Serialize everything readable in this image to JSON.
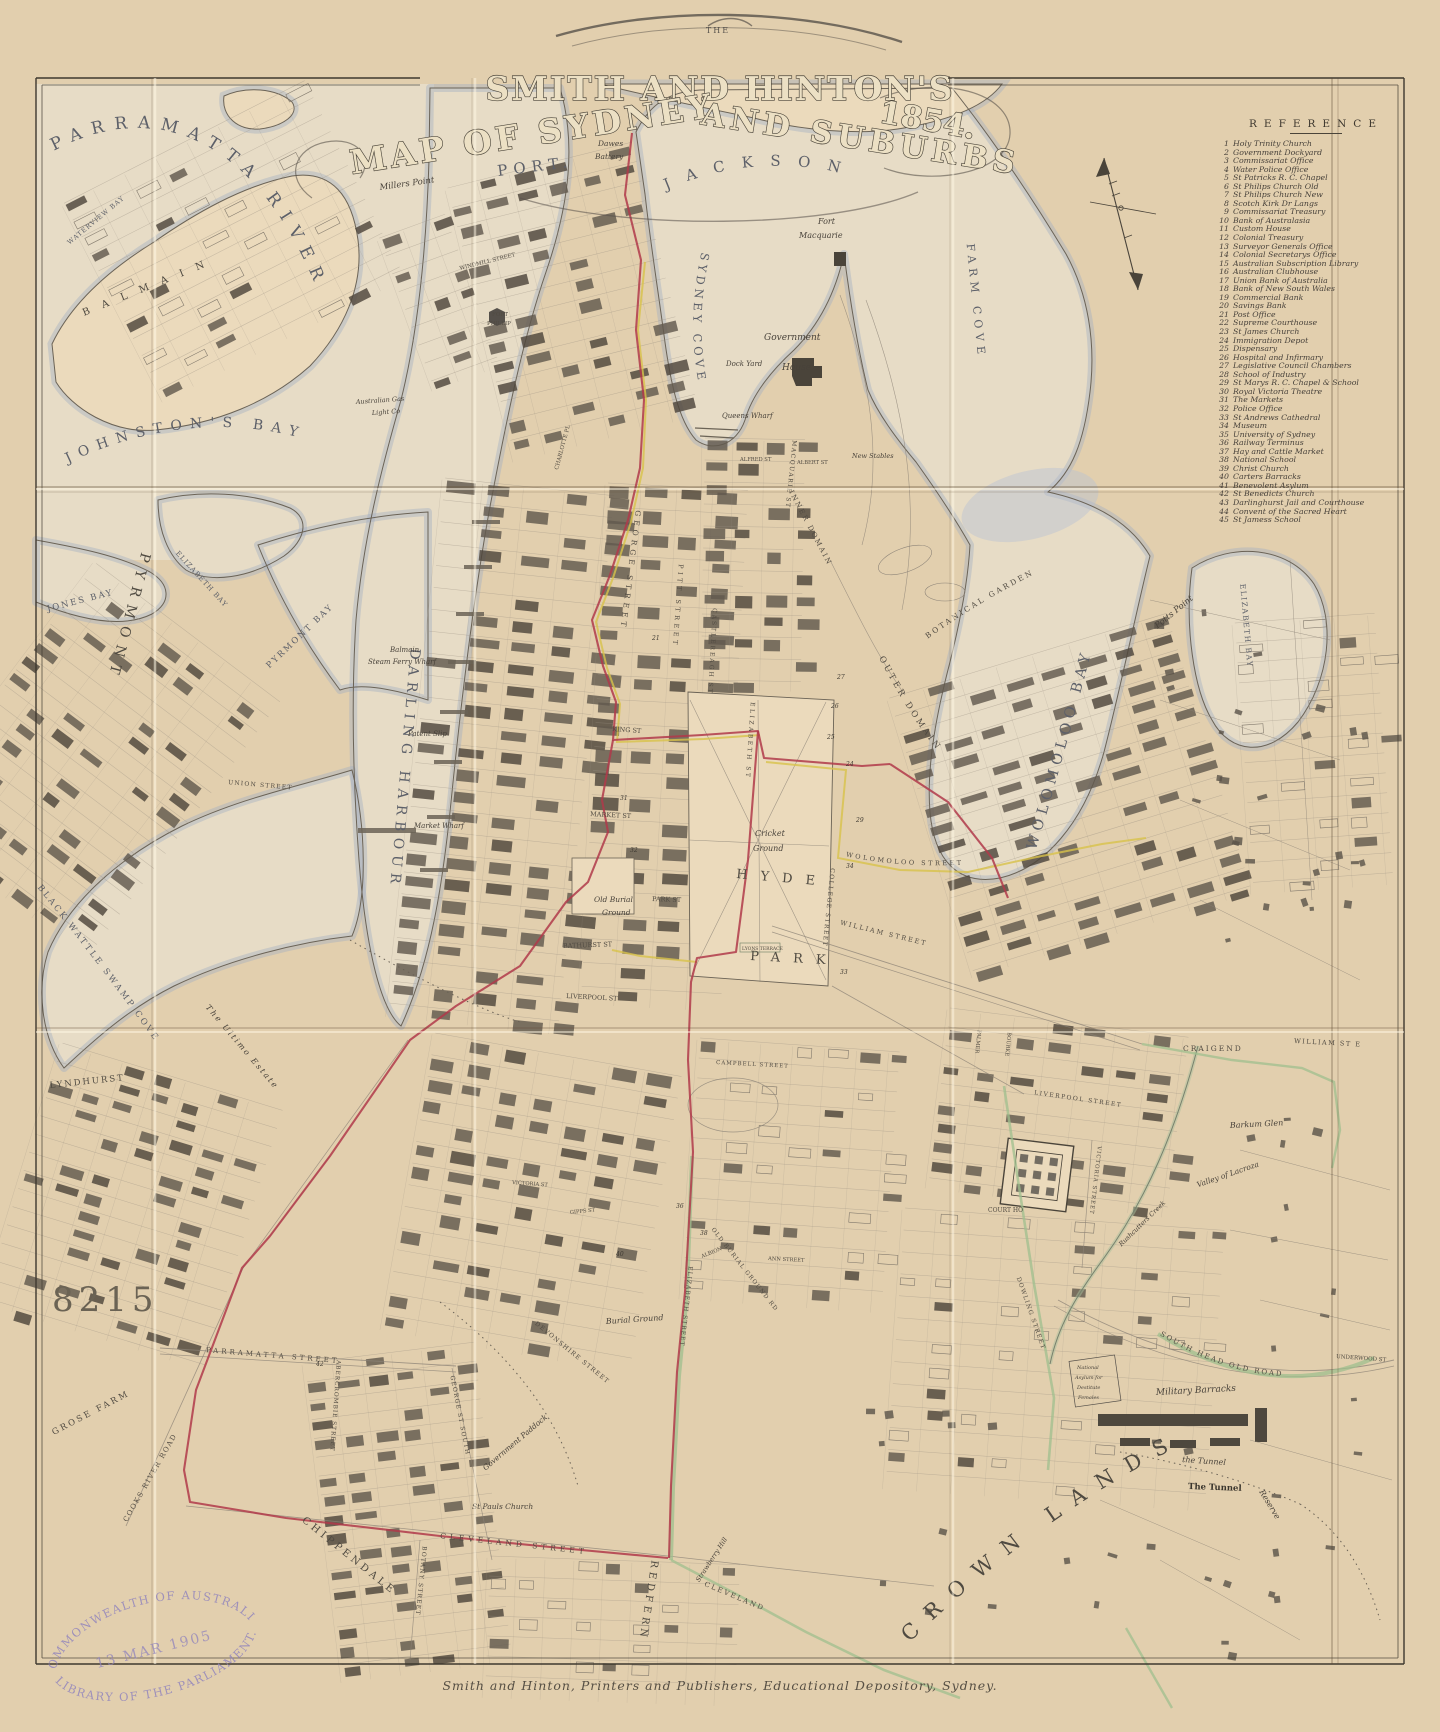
{
  "page": {
    "pretitle": "THE",
    "title_main": "SMITH AND HINTON'S",
    "title_sub_left": "MAP OF SYDNEY",
    "title_sub_right": "AND SUBURBS",
    "title_year": "1854.",
    "imprint": "Smith and Hinton, Printers and Publishers, Educational Depository, Sydney.",
    "accession_number": "8215"
  },
  "stamp": {
    "top": "COMMONWEALTH OF AUSTRALIA",
    "date": "13 MAR 1905",
    "bottom": "LIBRARY OF THE PARLIAMENT."
  },
  "reference": {
    "heading": "REFERENCE",
    "items": [
      {
        "n": "1",
        "label": "Holy Trinity Church"
      },
      {
        "n": "2",
        "label": "Government Dockyard"
      },
      {
        "n": "3",
        "label": "Commissariat Office"
      },
      {
        "n": "4",
        "label": "Water Police Office"
      },
      {
        "n": "5",
        "label": "St Patricks R. C. Chapel"
      },
      {
        "n": "6",
        "label": "St Philips Church Old"
      },
      {
        "n": "7",
        "label": "St Philips Church New"
      },
      {
        "n": "8",
        "label": "Scotch Kirk Dr Langs"
      },
      {
        "n": "9",
        "label": "Commissariat Treasury"
      },
      {
        "n": "10",
        "label": "Bank of Australasia"
      },
      {
        "n": "11",
        "label": "Custom House"
      },
      {
        "n": "12",
        "label": "Colonial Treasury"
      },
      {
        "n": "13",
        "label": "Surveyor Generals Office"
      },
      {
        "n": "14",
        "label": "Colonial Secretarys Office"
      },
      {
        "n": "15",
        "label": "Australian Subscription Library"
      },
      {
        "n": "16",
        "label": "Australian Clubhouse"
      },
      {
        "n": "17",
        "label": "Union Bank of Australia"
      },
      {
        "n": "18",
        "label": "Bank of New South Wales"
      },
      {
        "n": "19",
        "label": "Commercial Bank"
      },
      {
        "n": "20",
        "label": "Savings Bank"
      },
      {
        "n": "21",
        "label": "Post Office"
      },
      {
        "n": "22",
        "label": "Supreme Courthouse"
      },
      {
        "n": "23",
        "label": "St James Church"
      },
      {
        "n": "24",
        "label": "Immigration Depot"
      },
      {
        "n": "25",
        "label": "Dispensary"
      },
      {
        "n": "26",
        "label": "Hospital and Infirmary"
      },
      {
        "n": "27",
        "label": "Legislative Council Chambers"
      },
      {
        "n": "28",
        "label": "School of Industry"
      },
      {
        "n": "29",
        "label": "St Marys R. C. Chapel & School"
      },
      {
        "n": "30",
        "label": "Royal Victoria Theatre"
      },
      {
        "n": "31",
        "label": "The Markets"
      },
      {
        "n": "32",
        "label": "Police Office"
      },
      {
        "n": "33",
        "label": "St Andrews Cathedral"
      },
      {
        "n": "34",
        "label": "Museum"
      },
      {
        "n": "35",
        "label": "University of Sydney"
      },
      {
        "n": "36",
        "label": "Railway Terminus"
      },
      {
        "n": "37",
        "label": "Hay and Cattle Market"
      },
      {
        "n": "38",
        "label": "National School"
      },
      {
        "n": "39",
        "label": "Christ Church"
      },
      {
        "n": "40",
        "label": "Carters Barracks"
      },
      {
        "n": "41",
        "label": "Benevolent Asylum"
      },
      {
        "n": "42",
        "label": "St Benedicts Church"
      },
      {
        "n": "43",
        "label": "Darlinghurst Jail and Courthouse"
      },
      {
        "n": "44",
        "label": "Convent of the Sacred Heart"
      },
      {
        "n": "45",
        "label": "St Jamess School"
      }
    ]
  },
  "map_labels": [
    {
      "t": "PARRAMATTA RIVER",
      "cls": "w",
      "s": 17,
      "ls": 10,
      "p": "M52,152 C150,98 262,128 328,318"
    },
    {
      "t": "WATERVIEW BAY",
      "cls": "w",
      "s": 6.5,
      "ls": 1,
      "p": "M68,246 L150,178"
    },
    {
      "t": "B A L M A I N",
      "cls": "d",
      "s": 10,
      "ls": 5,
      "x": 84,
      "y": 316,
      "r": -22
    },
    {
      "t": "JOHNSTON'S BAY",
      "cls": "w",
      "s": 14,
      "ls": 8,
      "p": "M66,464 C160,418 258,416 340,452"
    },
    {
      "t": "PORT.",
      "cls": "w",
      "s": 15,
      "ls": 6,
      "x": 498,
      "y": 176,
      "r": -7
    },
    {
      "t": "JACKSON",
      "cls": "w",
      "s": 15,
      "ls": 17,
      "p": "M650,198 C740,150 845,156 938,214",
      "o": 18
    },
    {
      "t": "SYDNEY COVE",
      "cls": "w",
      "s": 11.5,
      "ls": 4,
      "p": "M702,250 C686,320 692,385 718,448"
    },
    {
      "t": "FARM COVE",
      "cls": "w",
      "s": 11,
      "ls": 5,
      "p": "M966,238 L985,428",
      "o": 6
    },
    {
      "t": "WOLOMOLOO BAY",
      "cls": "w",
      "s": 14.5,
      "ls": 5,
      "p": "M1030,870 C1068,742 1096,640 1124,516",
      "o": 20
    },
    {
      "t": "ELIZABETH BAY",
      "cls": "w",
      "s": 7.5,
      "ls": 1.5,
      "p": "M1240,582 L1254,742"
    },
    {
      "t": "Potts Point",
      "cls": "p",
      "s": 8.5,
      "p": "M1156,630 L1222,576"
    },
    {
      "t": "DARLING HARBOUR",
      "cls": "w",
      "s": 14,
      "ls": 6,
      "p": "M412,636 C400,762 392,884 378,1008",
      "o": 12
    },
    {
      "t": "PYRMONT",
      "cls": "d",
      "s": 14,
      "ls": 8,
      "p": "M142,550 L104,694"
    },
    {
      "t": "PYRMONT BAY",
      "cls": "w",
      "s": 8.5,
      "ls": 2,
      "p": "M268,670 L356,586"
    },
    {
      "t": "JONES BAY",
      "cls": "w",
      "s": 8.5,
      "ls": 2,
      "p": "M46,612 L132,590"
    },
    {
      "t": "ELIZABETH BAY",
      "cls": "w",
      "s": 7,
      "ls": 1,
      "p": "M174,552 L238,622"
    },
    {
      "t": "BLACK WATTLE SWAMP COVE",
      "cls": "w",
      "s": 8.5,
      "ls": 2.5,
      "p": "M36,886 C95,958 158,1044 214,1124"
    },
    {
      "t": "The Ultimo Estate",
      "cls": "p",
      "s": 8,
      "ls": 2,
      "p": "M204,1006 L306,1126"
    },
    {
      "t": "LYNDHURST",
      "cls": "d",
      "s": 8.5,
      "ls": 2,
      "x": 50,
      "y": 1088,
      "r": -6
    },
    {
      "t": "HYDE",
      "cls": "d",
      "s": 13,
      "ls": 13,
      "x": 736,
      "y": 878,
      "r": 5
    },
    {
      "t": "PARK",
      "cls": "d",
      "s": 13,
      "ls": 13,
      "x": 750,
      "y": 960,
      "r": 3
    },
    {
      "t": "Cricket",
      "cls": "p",
      "s": 8,
      "x": 755,
      "y": 836
    },
    {
      "t": "Ground",
      "cls": "p",
      "s": 8,
      "x": 753,
      "y": 851
    },
    {
      "t": "INNER DOMAIN",
      "cls": "s",
      "s": 7,
      "ls": 2,
      "p": "M788,490 L842,592"
    },
    {
      "t": "OUTER DOMAIN",
      "cls": "s",
      "s": 8.5,
      "ls": 3,
      "p": "M878,656 C912,722 946,766 980,798"
    },
    {
      "t": "BOTANICAL GARDEN",
      "cls": "s",
      "s": 7.5,
      "ls": 2.5,
      "p": "M926,640 C980,600 1040,570 1096,544"
    },
    {
      "t": "CROWN LANDS",
      "cls": "d",
      "s": 21,
      "ls": 15,
      "p": "M908,1644 C1010,1544 1108,1478 1212,1430"
    },
    {
      "t": "GROSE FARM",
      "cls": "s",
      "s": 8.5,
      "ls": 2.5,
      "p": "M52,1436 L136,1392"
    },
    {
      "t": "COOKS RIVER ROAD",
      "cls": "s",
      "s": 7,
      "ls": 1.5,
      "p": "M126,1524 L204,1388"
    },
    {
      "t": "CHIPPENDALE",
      "cls": "d",
      "s": 10,
      "ls": 3.5,
      "p": "M300,1520 L402,1602"
    },
    {
      "t": "REDFERN",
      "cls": "d",
      "s": 10,
      "ls": 4,
      "p": "M652,1558 L637,1656"
    },
    {
      "t": "GEORGE STREET",
      "cls": "s",
      "s": 7.5,
      "ls": 4,
      "p": "M636,508 L590,868"
    },
    {
      "t": "PITT STREET",
      "cls": "s",
      "s": 6.5,
      "ls": 3.5,
      "p": "M679,562 L656,878"
    },
    {
      "t": "CASTLEREAGH ST",
      "cls": "s",
      "s": 6,
      "ls": 2,
      "p": "M713,606 L698,882"
    },
    {
      "t": "ELIZABETH ST",
      "cls": "s",
      "s": 6,
      "ls": 2.5,
      "p": "M751,700 L736,926"
    },
    {
      "t": "MACQUARIE ST",
      "cls": "s",
      "s": 6,
      "ls": 1.5,
      "p": "M793,438 L780,562"
    },
    {
      "t": "COLLEGE STREET",
      "cls": "s",
      "s": 6,
      "ls": 1.5,
      "p": "M831,866 L818,992"
    },
    {
      "t": "WILLIAM STREET",
      "cls": "s",
      "s": 6.5,
      "ls": 2,
      "p": "M838,924 L944,950"
    },
    {
      "t": "WOLOMOLOO STREET",
      "cls": "s",
      "s": 6.5,
      "ls": 2.5,
      "p": "M844,856 C900,868 962,868 1024,858"
    },
    {
      "t": "KING ST",
      "cls": "s",
      "s": 6.5,
      "x": 612,
      "y": 731,
      "r": 4
    },
    {
      "t": "MARKET ST",
      "cls": "s",
      "s": 6.5,
      "x": 590,
      "y": 816,
      "r": 3
    },
    {
      "t": "PARK ST",
      "cls": "s",
      "s": 6.5,
      "x": 652,
      "y": 901,
      "r": 2
    },
    {
      "t": "BATHURST ST",
      "cls": "s",
      "s": 6.5,
      "x": 563,
      "y": 948,
      "r": -2
    },
    {
      "t": "LIVERPOOL ST",
      "cls": "s",
      "s": 6.5,
      "x": 566,
      "y": 998,
      "r": 3
    },
    {
      "t": "LIVERPOOL STREET",
      "cls": "s",
      "s": 6,
      "ls": 1.5,
      "p": "M1032,1094 L1142,1110"
    },
    {
      "t": "VICTORIA STREET",
      "cls": "s",
      "s": 5.5,
      "ls": 1,
      "p": "M1098,1144 L1084,1264"
    },
    {
      "t": "DOWLING STREET",
      "cls": "s",
      "s": 6,
      "ls": 1.2,
      "p": "M1016,1276 L1061,1404"
    },
    {
      "t": "SOUTH HEAD OLD ROAD",
      "cls": "s",
      "s": 7,
      "ls": 2,
      "p": "M1158,1334 C1240,1384 1312,1386 1374,1358"
    },
    {
      "t": "UNDERWOOD ST",
      "cls": "s",
      "s": 5.5,
      "x": 1336,
      "y": 1358,
      "r": 4
    },
    {
      "t": "CLEVELAND STREET",
      "cls": "s",
      "s": 7.5,
      "ls": 4,
      "p": "M438,1538 L642,1560"
    },
    {
      "t": "CLEVELAND",
      "cls": "s",
      "s": 7,
      "ls": 2,
      "p": "M702,1585 L776,1616"
    },
    {
      "t": "GEORGE ST SOUTH",
      "cls": "s",
      "s": 6,
      "ls": 1.2,
      "p": "M450,1374 L476,1506"
    },
    {
      "t": "BOTANY STREET",
      "cls": "s",
      "s": 6,
      "ls": 1.2,
      "p": "M423,1544 L412,1652"
    },
    {
      "t": "ABERCROMBIE STREET",
      "cls": "s",
      "s": 5.8,
      "ls": 1,
      "p": "M337,1358 L326,1512"
    },
    {
      "t": "DEVONSHIRE STREET",
      "cls": "s",
      "s": 6.2,
      "ls": 1.2,
      "p": "M533,1323 L642,1412"
    },
    {
      "t": "ELIZABETH STREET",
      "cls": "s",
      "s": 6,
      "ls": 1,
      "p": "M689,1264 L676,1382"
    },
    {
      "t": "OLD BURIAL GROUND RD",
      "cls": "s",
      "s": 5.8,
      "ls": 1.2,
      "p": "M710,1228 L864,1424"
    },
    {
      "t": "PARRAMATTA STREET",
      "cls": "s",
      "s": 7,
      "ls": 3,
      "p": "M204,1352 L400,1368"
    },
    {
      "t": "UNION STREET",
      "cls": "s",
      "s": 6,
      "ls": 1.2,
      "p": "M226,784 L324,792"
    },
    {
      "t": "Strawberry Hill",
      "cls": "p",
      "s": 6.5,
      "p": "M698,1584 L744,1514"
    },
    {
      "t": "Rushcutters Creek",
      "cls": "p",
      "s": 6.5,
      "p": "M1120,1248 L1200,1170"
    },
    {
      "t": "Valley of Lacroza",
      "cls": "p",
      "s": 7.5,
      "p": "M1196,1188 L1306,1150"
    },
    {
      "t": "Reserve",
      "cls": "p",
      "s": 8,
      "p": "M1258,1490 L1304,1566"
    },
    {
      "t": "Government Paddock",
      "cls": "p",
      "s": 7.5,
      "p": "M484,1472 L590,1382"
    },
    {
      "t": "Burial Ground",
      "cls": "p",
      "s": 8,
      "x": 606,
      "y": 1324,
      "r": -4
    },
    {
      "t": "Old Burial",
      "cls": "p",
      "s": 7.5,
      "x": 594,
      "y": 902
    },
    {
      "t": "Ground",
      "cls": "p",
      "s": 7.5,
      "x": 602,
      "y": 915
    },
    {
      "t": "Government",
      "cls": "p",
      "s": 9,
      "x": 764,
      "y": 340
    },
    {
      "t": "House",
      "cls": "p",
      "s": 9,
      "x": 782,
      "y": 370
    },
    {
      "t": "Fort",
      "cls": "p",
      "s": 8,
      "x": 818,
      "y": 224
    },
    {
      "t": "Macquarie",
      "cls": "p",
      "s": 8,
      "x": 799,
      "y": 238
    },
    {
      "t": "Dawes",
      "cls": "p",
      "s": 7.5,
      "x": 598,
      "y": 146
    },
    {
      "t": "Battery",
      "cls": "p",
      "s": 7.5,
      "x": 595,
      "y": 159
    },
    {
      "t": "Millers Point",
      "cls": "p",
      "s": 8.5,
      "x": 380,
      "y": 190,
      "r": -8
    },
    {
      "t": "Australian Gas",
      "cls": "p",
      "s": 6.5,
      "x": 356,
      "y": 404,
      "r": -4
    },
    {
      "t": "Light Co",
      "cls": "p",
      "s": 6.5,
      "x": 372,
      "y": 415,
      "r": -4
    },
    {
      "t": "WINDMILL STREET",
      "cls": "s",
      "s": 5.5,
      "x": 460,
      "y": 270,
      "r": -14
    },
    {
      "t": "FORT",
      "cls": "s",
      "s": 5.5,
      "x": 492,
      "y": 316
    },
    {
      "t": "PHILLIP",
      "cls": "s",
      "s": 5.5,
      "x": 487,
      "y": 325
    },
    {
      "t": "CHARLOTTE PL",
      "cls": "s",
      "s": 5.5,
      "x": 558,
      "y": 470,
      "r": -75
    },
    {
      "t": "Queens Wharf",
      "cls": "p",
      "s": 7,
      "x": 722,
      "y": 418
    },
    {
      "t": "Dock Yard",
      "cls": "p",
      "s": 7,
      "x": 726,
      "y": 366
    },
    {
      "t": "New Stables",
      "cls": "p",
      "s": 6.5,
      "x": 852,
      "y": 458
    },
    {
      "t": "ALFRED ST",
      "cls": "s",
      "s": 5.2,
      "x": 740,
      "y": 461
    },
    {
      "t": "ALBERT ST",
      "cls": "s",
      "s": 5.2,
      "x": 797,
      "y": 464
    },
    {
      "t": "Balmain",
      "cls": "p",
      "s": 7,
      "x": 390,
      "y": 652
    },
    {
      "t": "Steam Ferry Wharf",
      "cls": "p",
      "s": 7,
      "x": 368,
      "y": 664
    },
    {
      "t": "Patent Slip",
      "cls": "p",
      "s": 7,
      "x": 408,
      "y": 736
    },
    {
      "t": "Market Wharf",
      "cls": "p",
      "s": 7,
      "x": 414,
      "y": 828
    },
    {
      "t": "CRAIGEND",
      "cls": "s",
      "s": 7.5,
      "ls": 2,
      "x": 1183,
      "y": 1051
    },
    {
      "t": "WILLIAM ST E",
      "cls": "s",
      "s": 6.5,
      "ls": 1.5,
      "x": 1294,
      "y": 1043,
      "r": 3
    },
    {
      "t": "Barkum Glen",
      "cls": "p",
      "s": 8,
      "x": 1230,
      "y": 1128,
      "r": -3
    },
    {
      "t": "COURT HO",
      "cls": "s",
      "s": 6,
      "x": 988,
      "y": 1212
    },
    {
      "t": "Military Barracks",
      "cls": "p",
      "s": 9,
      "x": 1156,
      "y": 1395,
      "r": -3
    },
    {
      "t": "the Tunnel",
      "cls": "p",
      "s": 8,
      "x": 1182,
      "y": 1462,
      "r": 4
    },
    {
      "t": "The Tunnel",
      "cls": "pb",
      "s": 8.5,
      "x": 1188,
      "y": 1489,
      "r": 2
    },
    {
      "t": "National",
      "cls": "p",
      "s": 5,
      "x": 1077,
      "y": 1369
    },
    {
      "t": "Asylum for",
      "cls": "p",
      "s": 5,
      "x": 1075,
      "y": 1379
    },
    {
      "t": "Destitute",
      "cls": "p",
      "s": 5,
      "x": 1077,
      "y": 1389
    },
    {
      "t": "Females",
      "cls": "p",
      "s": 5,
      "x": 1078,
      "y": 1399
    },
    {
      "t": "St Pauls Church",
      "cls": "p",
      "s": 7.5,
      "x": 472,
      "y": 1509
    },
    {
      "t": "LYONS TERRACE",
      "cls": "s",
      "s": 4.5,
      "x": 742,
      "y": 950
    },
    {
      "t": "GIPPS ST",
      "cls": "s",
      "s": 5.2,
      "x": 570,
      "y": 1214,
      "r": -6
    },
    {
      "t": "VICTORIA ST",
      "cls": "s",
      "s": 5.2,
      "x": 512,
      "y": 1184,
      "r": 4
    },
    {
      "t": "CAMPBELL STREET",
      "cls": "s",
      "s": 5.5,
      "ls": 1,
      "x": 716,
      "y": 1064,
      "r": 3
    },
    {
      "t": "ANN STREET",
      "cls": "s",
      "s": 5.2,
      "x": 768,
      "y": 1260,
      "r": 3
    },
    {
      "t": "ALBION",
      "cls": "s",
      "s": 5.2,
      "x": 702,
      "y": 1258,
      "r": -22
    },
    {
      "t": "PALMER",
      "cls": "s",
      "s": 5.2,
      "p": "M978,1028 L973,1074"
    },
    {
      "t": "BOURKE",
      "cls": "s",
      "s": 5.2,
      "p": "M1008,1030 L1003,1078"
    }
  ],
  "map_numbers": [
    {
      "n": "21",
      "x": 652,
      "y": 640
    },
    {
      "n": "24",
      "x": 846,
      "y": 766
    },
    {
      "n": "25",
      "x": 827,
      "y": 739
    },
    {
      "n": "26",
      "x": 831,
      "y": 708
    },
    {
      "n": "27",
      "x": 837,
      "y": 679
    },
    {
      "n": "29",
      "x": 856,
      "y": 822
    },
    {
      "n": "31",
      "x": 620,
      "y": 800
    },
    {
      "n": "32",
      "x": 630,
      "y": 852
    },
    {
      "n": "33",
      "x": 840,
      "y": 974
    },
    {
      "n": "34",
      "x": 846,
      "y": 868
    },
    {
      "n": "36",
      "x": 676,
      "y": 1208
    },
    {
      "n": "38",
      "x": 700,
      "y": 1235
    },
    {
      "n": "40",
      "x": 616,
      "y": 1256
    },
    {
      "n": "42",
      "x": 316,
      "y": 1366
    }
  ],
  "colors": {
    "paper": "#ead9ba",
    "water_shade": "#a3adc0",
    "ink": "#4e483e",
    "route_red": "#b03a4a",
    "route_yellow": "#d8c24a",
    "route_green": "#9fbf8e",
    "stamp_purple": "#9083bd"
  }
}
